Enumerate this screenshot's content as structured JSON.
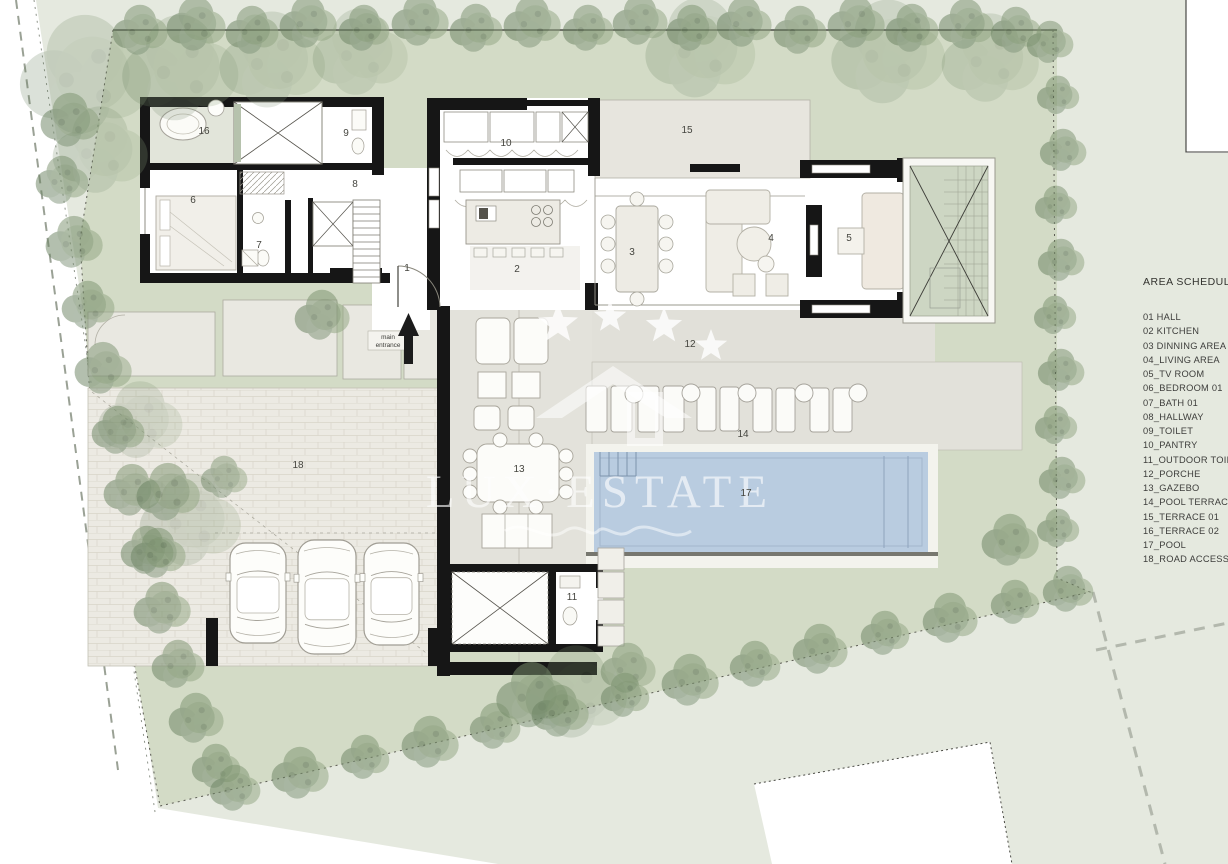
{
  "watermark": {
    "brand": "LUX·ESTATE"
  },
  "entrance": {
    "line1": "main",
    "line2": "entrance"
  },
  "legend": {
    "title": "AREA SCHEDULE",
    "items": [
      "01  HALL",
      "02  KITCHEN",
      "03  DINNING AREA",
      "04_LIVING AREA",
      "05_TV ROOM",
      "06_BEDROOM 01",
      "07_BATH 01",
      "08_HALLWAY",
      "09_TOILET",
      "10_PANTRY",
      "11_OUTDOOR TOILET",
      "12_PORCHE",
      "13_GAZEBO",
      "14_POOL TERRACE",
      "15_TERRACE 01",
      "16_TERRACE 02",
      "17_POOL",
      "18_ROAD ACCESS"
    ]
  },
  "plan_labels": [
    {
      "t": "1",
      "x": 407,
      "y": 271
    },
    {
      "t": "2",
      "x": 517,
      "y": 272
    },
    {
      "t": "3",
      "x": 632,
      "y": 255
    },
    {
      "t": "4",
      "x": 771,
      "y": 241
    },
    {
      "t": "5",
      "x": 849,
      "y": 241
    },
    {
      "t": "6",
      "x": 193,
      "y": 203
    },
    {
      "t": "7",
      "x": 259,
      "y": 248
    },
    {
      "t": "8",
      "x": 355,
      "y": 187
    },
    {
      "t": "9",
      "x": 346,
      "y": 136
    },
    {
      "t": "10",
      "x": 506,
      "y": 146
    },
    {
      "t": "11",
      "x": 572,
      "y": 600
    },
    {
      "t": "12",
      "x": 690,
      "y": 347
    },
    {
      "t": "13",
      "x": 519,
      "y": 472
    },
    {
      "t": "14",
      "x": 743,
      "y": 437
    },
    {
      "t": "15",
      "x": 687,
      "y": 133
    },
    {
      "t": "16",
      "x": 204,
      "y": 134
    },
    {
      "t": "17",
      "x": 746,
      "y": 496
    },
    {
      "t": "18",
      "x": 298,
      "y": 468
    }
  ],
  "stars": [
    {
      "x": 558,
      "y": 324,
      "r": 21
    },
    {
      "x": 610,
      "y": 317,
      "r": 17
    },
    {
      "x": 664,
      "y": 326,
      "r": 19
    },
    {
      "x": 711,
      "y": 346,
      "r": 17
    }
  ],
  "cars": [
    {
      "x": 230,
      "y": 543,
      "w": 56,
      "h": 100
    },
    {
      "x": 298,
      "y": 540,
      "w": 58,
      "h": 114
    },
    {
      "x": 364,
      "y": 543,
      "w": 55,
      "h": 102
    }
  ],
  "trees": [
    [
      85,
      75,
      62,
      0.28
    ],
    [
      180,
      68,
      55,
      0.28
    ],
    [
      272,
      60,
      50,
      0.26
    ],
    [
      360,
      52,
      45,
      0.25
    ],
    [
      700,
      48,
      52,
      0.26
    ],
    [
      888,
      52,
      54,
      0.26
    ],
    [
      990,
      58,
      46,
      0.25
    ],
    [
      140,
      30,
      26
    ],
    [
      196,
      24,
      28
    ],
    [
      252,
      30,
      25
    ],
    [
      308,
      22,
      27
    ],
    [
      364,
      28,
      24
    ],
    [
      420,
      20,
      27
    ],
    [
      476,
      28,
      25
    ],
    [
      532,
      22,
      27
    ],
    [
      588,
      28,
      24
    ],
    [
      640,
      20,
      26
    ],
    [
      692,
      28,
      24
    ],
    [
      744,
      22,
      26
    ],
    [
      800,
      30,
      25
    ],
    [
      856,
      22,
      27
    ],
    [
      912,
      28,
      25
    ],
    [
      966,
      24,
      26
    ],
    [
      1016,
      30,
      24
    ],
    [
      1050,
      42,
      22
    ],
    [
      70,
      120,
      28
    ],
    [
      62,
      180,
      25
    ],
    [
      74,
      242,
      27
    ],
    [
      88,
      305,
      25
    ],
    [
      103,
      368,
      27
    ],
    [
      118,
      430,
      25
    ],
    [
      132,
      490,
      27
    ],
    [
      147,
      550,
      25
    ],
    [
      162,
      608,
      27
    ],
    [
      178,
      664,
      25
    ],
    [
      196,
      718,
      26
    ],
    [
      216,
      766,
      23
    ],
    [
      100,
      150,
      45,
      0.26
    ],
    [
      140,
      420,
      40,
      0.25
    ],
    [
      190,
      520,
      48,
      0.26
    ],
    [
      322,
      315,
      26,
      0.62
    ],
    [
      168,
      492,
      30,
      0.6
    ],
    [
      224,
      477,
      22,
      0.55
    ],
    [
      158,
      553,
      26,
      0.6
    ],
    [
      532,
      695,
      34,
      0.6
    ],
    [
      628,
      668,
      26,
      0.55
    ],
    [
      576,
      692,
      48,
      0.28
    ],
    [
      235,
      788,
      24
    ],
    [
      300,
      773,
      27
    ],
    [
      365,
      757,
      23
    ],
    [
      430,
      742,
      27
    ],
    [
      495,
      726,
      24
    ],
    [
      560,
      711,
      27
    ],
    [
      625,
      695,
      23
    ],
    [
      690,
      680,
      27
    ],
    [
      755,
      664,
      24
    ],
    [
      820,
      649,
      26
    ],
    [
      885,
      633,
      23
    ],
    [
      950,
      618,
      26
    ],
    [
      1015,
      602,
      23
    ],
    [
      1068,
      589,
      24
    ],
    [
      1058,
      95,
      20
    ],
    [
      1063,
      150,
      22
    ],
    [
      1056,
      205,
      20
    ],
    [
      1061,
      260,
      22
    ],
    [
      1055,
      315,
      20
    ],
    [
      1061,
      370,
      22
    ],
    [
      1056,
      425,
      20
    ],
    [
      1062,
      478,
      22
    ],
    [
      1058,
      528,
      20
    ],
    [
      1010,
      540,
      27
    ]
  ],
  "colors": {
    "lawn_inner": "#d3dbc6",
    "lawn_outer": "#e5e9df",
    "water": "#b9cce0",
    "wall": "#161616",
    "paving": "#eceae3",
    "terrace": "#e2e1da",
    "watermark": "#ffffff"
  }
}
